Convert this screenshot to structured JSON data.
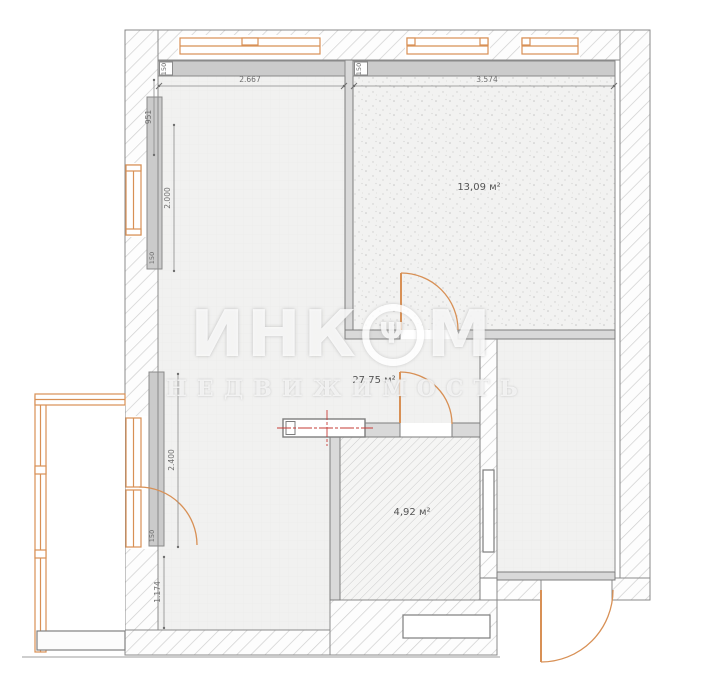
{
  "watermark": {
    "brand_prefix": "ИНК",
    "emblem_glyph": "Ψ",
    "brand_suffix": "М",
    "subtitle": "НЕДВИЖИМОСТЬ"
  },
  "rooms": {
    "top_right": {
      "label": "13,09 м²"
    },
    "living": {
      "label": "27,75 м²"
    },
    "bathroom": {
      "label": "4,92 м²"
    }
  },
  "dimensions": {
    "top_left_width": "2.667",
    "top_right_width": "3.574",
    "left_951": "951",
    "left_2000": "2.000",
    "left_2400": "2.400",
    "left_1174": "1.174",
    "corner_150_left": "150",
    "corner_150_right": "150",
    "strip_150_upper": "150",
    "strip_150_lower": "150"
  },
  "colors": {
    "window_orange": "#d89055",
    "centerline_red": "#c63b36",
    "dim_gray": "#6e6e6e",
    "wall_line": "#7d7d7d"
  }
}
